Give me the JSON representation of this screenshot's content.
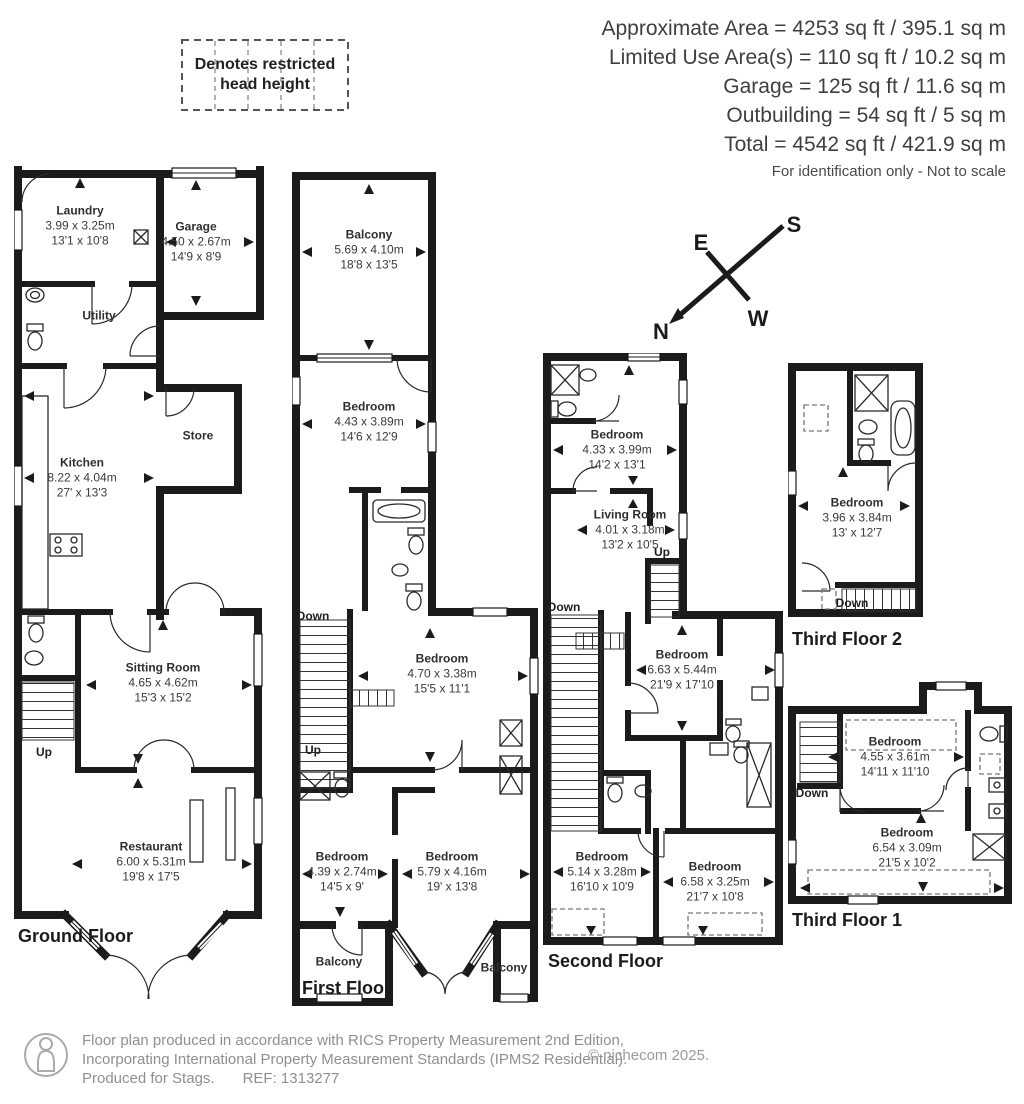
{
  "header": {
    "area_lines": [
      "Approximate Area = 4253 sq ft / 395.1 sq m",
      "Limited Use Area(s) = 110 sq ft / 10.2 sq m",
      "Garage = 125 sq ft / 11.6 sq m",
      "Outbuilding = 54 sq ft / 5 sq m",
      "Total = 4542 sq ft / 421.9 sq m"
    ],
    "note": "For identification only - Not to scale"
  },
  "legend": {
    "label_line1": "Denotes restricted",
    "label_line2": "head height"
  },
  "compass": {
    "n": "N",
    "e": "E",
    "s": "S",
    "w": "W"
  },
  "colors": {
    "wall": "#1b1b1b",
    "text": "#3b3b3b",
    "footer_text": "#8f8f8f"
  },
  "floors": {
    "ground": {
      "title": "Ground Floor",
      "up_label": "Up",
      "rooms": {
        "laundry": {
          "name": "Laundry",
          "metric": "3.99 x 3.25m",
          "imperial": "13'1 x 10'8"
        },
        "garage": {
          "name": "Garage",
          "metric": "4.50 x 2.67m",
          "imperial": "14'9 x 8'9"
        },
        "utility": {
          "name": "Utility"
        },
        "kitchen": {
          "name": "Kitchen",
          "metric": "8.22 x 4.04m",
          "imperial": "27' x 13'3"
        },
        "store": {
          "name": "Store"
        },
        "sitting_room": {
          "name": "Sitting Room",
          "metric": "4.65 x 4.62m",
          "imperial": "15'3 x 15'2"
        },
        "restaurant": {
          "name": "Restaurant",
          "metric": "6.00 x 5.31m",
          "imperial": "19'8 x 17'5"
        }
      }
    },
    "first": {
      "title": "First Floor",
      "up_label": "Up",
      "down_label": "Down",
      "rooms": {
        "balcony_top": {
          "name": "Balcony",
          "metric": "5.69 x 4.10m",
          "imperial": "18'8 x 13'5"
        },
        "bedroom_front": {
          "name": "Bedroom",
          "metric": "4.43 x 3.89m",
          "imperial": "14'6 x 12'9"
        },
        "bedroom_middle": {
          "name": "Bedroom",
          "metric": "4.70 x 3.38m",
          "imperial": "15'5 x 11'1"
        },
        "bedroom_rear_left": {
          "name": "Bedroom",
          "metric": "4.39 x 2.74m",
          "imperial": "14'5 x 9'"
        },
        "bedroom_rear_right": {
          "name": "Bedroom",
          "metric": "5.79 x 4.16m",
          "imperial": "19' x 13'8"
        },
        "balcony_left": {
          "name": "Balcony"
        },
        "balcony_right": {
          "name": "Balcony"
        }
      }
    },
    "second": {
      "title": "Second Floor",
      "up_label": "Up",
      "down_label": "Down",
      "rooms": {
        "bedroom_front": {
          "name": "Bedroom",
          "metric": "4.33 x 3.99m",
          "imperial": "14'2 x 13'1"
        },
        "living_room": {
          "name": "Living Room",
          "metric": "4.01 x 3.18m",
          "imperial": "13'2 x 10'5"
        },
        "bedroom_middle": {
          "name": "Bedroom",
          "metric": "6.63 x 5.44m",
          "imperial": "21'9 x 17'10"
        },
        "bedroom_rear_left": {
          "name": "Bedroom",
          "metric": "5.14 x 3.28m",
          "imperial": "16'10 x 10'9"
        },
        "bedroom_rear_right": {
          "name": "Bedroom",
          "metric": "6.58 x 3.25m",
          "imperial": "21'7 x 10'8"
        }
      }
    },
    "third2": {
      "title": "Third Floor 2",
      "down_label": "Down",
      "rooms": {
        "bedroom": {
          "name": "Bedroom",
          "metric": "3.96 x 3.84m",
          "imperial": "13' x 12'7"
        }
      }
    },
    "third1": {
      "title": "Third Floor 1",
      "down_label": "Down",
      "rooms": {
        "bedroom_upper": {
          "name": "Bedroom",
          "metric": "4.55 x 3.61m",
          "imperial": "14'11 x 11'10"
        },
        "bedroom_lower": {
          "name": "Bedroom",
          "metric": "6.54 x 3.09m",
          "imperial": "21'5 x 10'2"
        }
      }
    }
  },
  "footer": {
    "line1": "Floor plan produced in accordance with RICS Property Measurement 2nd Edition,",
    "line2": "Incorporating International Property Measurement Standards (IPMS2 Residential).",
    "line3_left": "Produced for Stags.",
    "line3_ref": "REF: 1313277",
    "copyright": "© nichecom 2025."
  }
}
